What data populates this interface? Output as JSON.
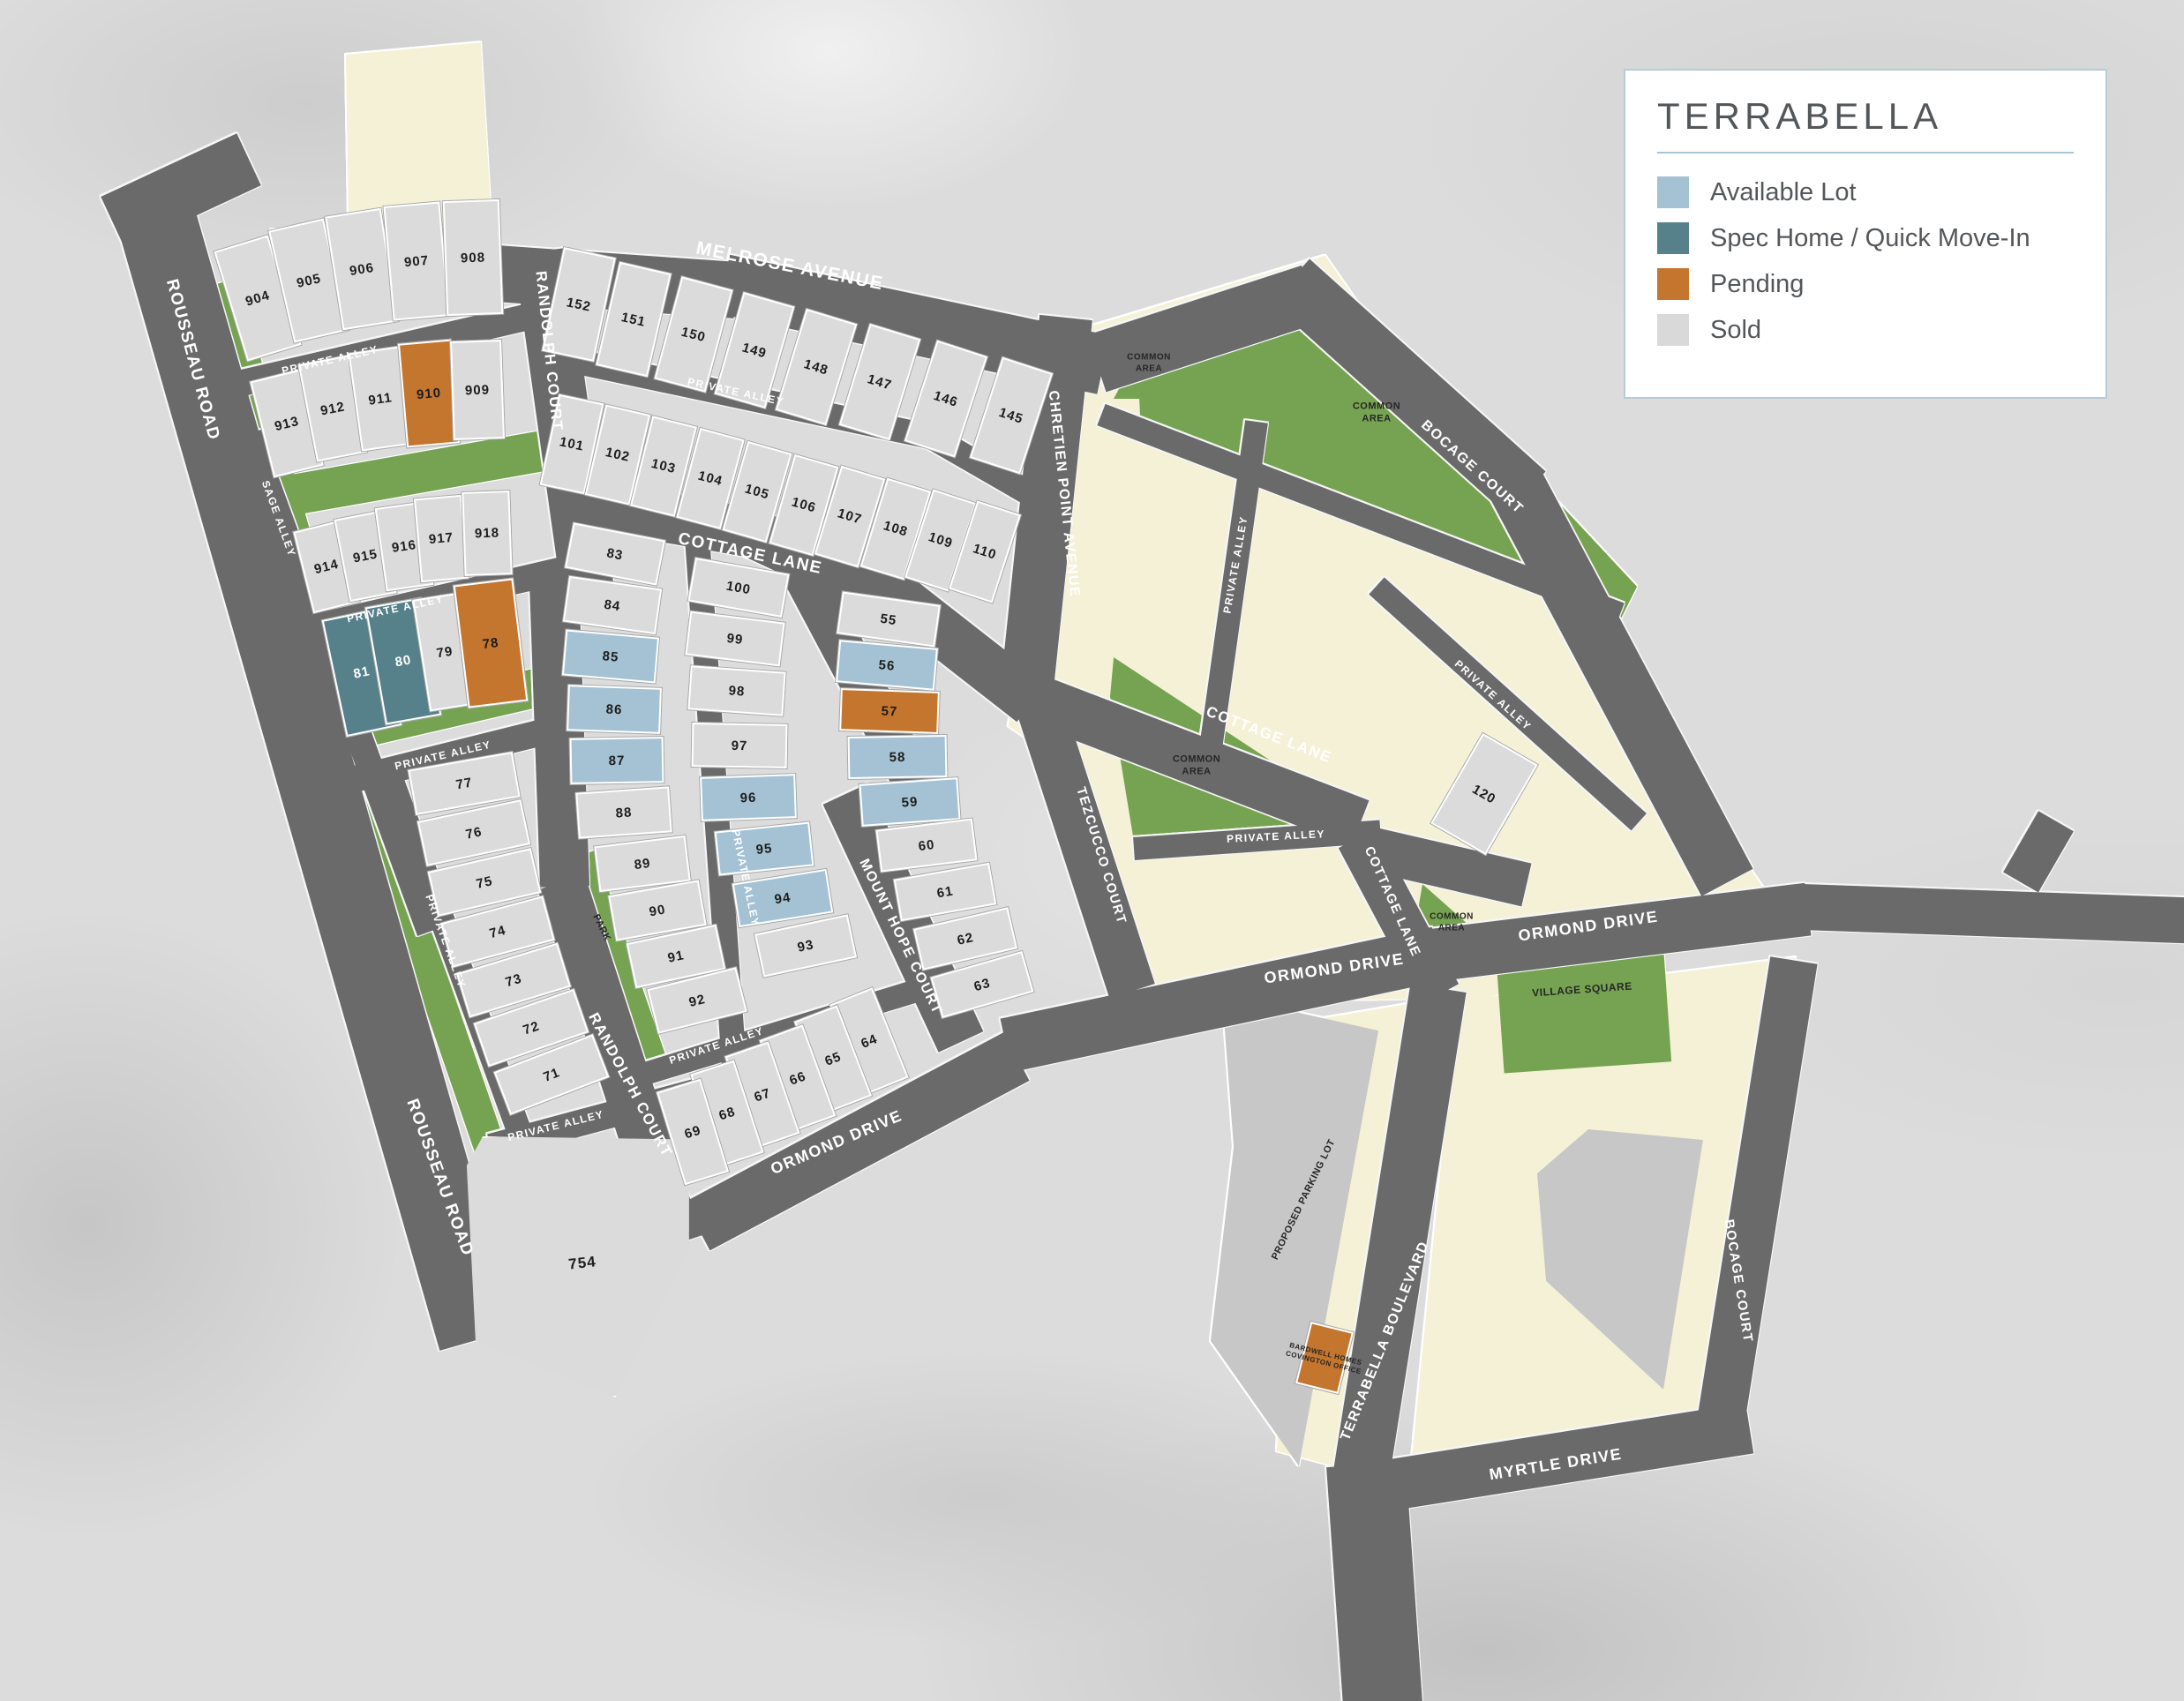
{
  "legend": {
    "title": "TERRABELLA",
    "items": [
      {
        "label": "Available Lot",
        "color": "#a4c2d3",
        "key": "available"
      },
      {
        "label": "Spec Home / Quick Move-In",
        "color": "#56808a",
        "key": "spec"
      },
      {
        "label": "Pending",
        "color": "#c4752e",
        "key": "pending"
      },
      {
        "label": "Sold",
        "color": "#d9d9d9",
        "key": "sold"
      }
    ]
  },
  "colors": {
    "available": "#a4c2d3",
    "spec": "#56808a",
    "pending": "#c4752e",
    "sold": "#dbdbdb",
    "road": "#6a6a6a",
    "green": "#76a351",
    "cream": "#f4f1d6",
    "pad": "#c7c7c7",
    "ink": "#54575a",
    "panel_border": "#b7cbd7",
    "rule": "#a8c4d6"
  },
  "lot_fields": [
    "number",
    "status(a=available,q=spec,p=pending,s=sold)",
    "cx",
    "cy",
    "w",
    "h",
    "rotate_deg",
    "clip_polygon(optional)"
  ],
  "lots": [
    [
      "904",
      "s",
      292,
      338,
      64,
      130,
      -17
    ],
    [
      "905",
      "s",
      350,
      318,
      64,
      130,
      -13
    ],
    [
      "906",
      "s",
      410,
      305,
      64,
      130,
      -9
    ],
    [
      "907",
      "s",
      472,
      296,
      64,
      130,
      -5
    ],
    [
      "908",
      "s",
      536,
      292,
      64,
      130,
      -2
    ],
    [
      "913",
      "s",
      325,
      480,
      58,
      112,
      -14
    ],
    [
      "912",
      "s",
      377,
      463,
      58,
      112,
      -11
    ],
    [
      "911",
      "s",
      431,
      452,
      58,
      112,
      -8
    ],
    [
      "910",
      "p",
      486,
      446,
      60,
      118,
      -5
    ],
    [
      "909",
      "s",
      541,
      442,
      58,
      112,
      -2
    ],
    [
      "914",
      "s",
      370,
      642,
      54,
      95,
      -14
    ],
    [
      "915",
      "s",
      414,
      630,
      54,
      95,
      -11
    ],
    [
      "916",
      "s",
      458,
      619,
      54,
      95,
      -8
    ],
    [
      "917",
      "s",
      500,
      610,
      54,
      95,
      -5
    ],
    [
      "918",
      "s",
      552,
      604,
      54,
      95,
      -2
    ],
    [
      "81",
      "q",
      410,
      762,
      64,
      135,
      -12
    ],
    [
      "80",
      "q",
      457,
      749,
      64,
      135,
      -10
    ],
    [
      "79",
      "s",
      504,
      739,
      54,
      128,
      -9
    ],
    [
      "78",
      "p",
      556,
      729,
      68,
      140,
      -7
    ],
    [
      "77",
      "s",
      526,
      888,
      120,
      52,
      -10
    ],
    [
      "76",
      "s",
      537,
      944,
      120,
      52,
      -12
    ],
    [
      "75",
      "s",
      549,
      1000,
      120,
      52,
      -13
    ],
    [
      "74",
      "s",
      564,
      1056,
      120,
      52,
      -15
    ],
    [
      "73",
      "s",
      582,
      1111,
      120,
      52,
      -17
    ],
    [
      "72",
      "s",
      602,
      1165,
      120,
      52,
      -19
    ],
    [
      "71",
      "s",
      625,
      1218,
      120,
      52,
      -21
    ],
    [
      "754",
      "s",
      660,
      1432,
      270,
      310,
      -6,
      "14% 0%,100% 9%,95% 50%,58% 100%,2% 74%,6% 10%"
    ],
    [
      "152",
      "s",
      656,
      345,
      60,
      120,
      12
    ],
    [
      "151",
      "s",
      718,
      362,
      60,
      120,
      13
    ],
    [
      "150",
      "s",
      786,
      379,
      60,
      120,
      15
    ],
    [
      "149",
      "s",
      855,
      397,
      60,
      120,
      16
    ],
    [
      "148",
      "s",
      925,
      416,
      60,
      120,
      17
    ],
    [
      "147",
      "s",
      997,
      433,
      60,
      120,
      17
    ],
    [
      "146",
      "s",
      1072,
      452,
      60,
      120,
      18
    ],
    [
      "145",
      "s",
      1146,
      471,
      60,
      120,
      18
    ],
    [
      "101",
      "s",
      648,
      503,
      52,
      105,
      12
    ],
    [
      "102",
      "s",
      700,
      515,
      52,
      105,
      13
    ],
    [
      "103",
      "s",
      752,
      528,
      52,
      105,
      14
    ],
    [
      "104",
      "s",
      805,
      542,
      52,
      105,
      15
    ],
    [
      "105",
      "s",
      858,
      557,
      52,
      105,
      16
    ],
    [
      "106",
      "s",
      911,
      572,
      52,
      105,
      16
    ],
    [
      "107",
      "s",
      963,
      585,
      52,
      105,
      17
    ],
    [
      "108",
      "s",
      1015,
      599,
      52,
      105,
      17
    ],
    [
      "109",
      "s",
      1066,
      612,
      52,
      105,
      18
    ],
    [
      "110",
      "s",
      1116,
      625,
      52,
      105,
      18
    ],
    [
      "83",
      "s",
      697,
      628,
      106,
      52,
      11
    ],
    [
      "84",
      "s",
      694,
      686,
      106,
      52,
      8
    ],
    [
      "85",
      "a",
      692,
      744,
      106,
      52,
      5
    ],
    [
      "86",
      "a",
      696,
      804,
      106,
      52,
      2
    ],
    [
      "87",
      "a",
      699,
      862,
      106,
      52,
      -1
    ],
    [
      "88",
      "s",
      707,
      921,
      106,
      52,
      -4
    ],
    [
      "89",
      "s",
      728,
      979,
      104,
      52,
      -7
    ],
    [
      "90",
      "s",
      745,
      1032,
      104,
      52,
      -10
    ],
    [
      "91",
      "s",
      766,
      1084,
      104,
      52,
      -12
    ],
    [
      "92",
      "s",
      790,
      1134,
      104,
      52,
      -14
    ],
    [
      "100",
      "s",
      837,
      666,
      108,
      50,
      10
    ],
    [
      "99",
      "s",
      833,
      724,
      108,
      50,
      7
    ],
    [
      "98",
      "s",
      835,
      783,
      108,
      50,
      4
    ],
    [
      "97",
      "s",
      838,
      845,
      108,
      50,
      1
    ],
    [
      "96",
      "a",
      848,
      904,
      108,
      50,
      -2
    ],
    [
      "95",
      "a",
      866,
      962,
      108,
      50,
      -6
    ],
    [
      "94",
      "a",
      887,
      1018,
      108,
      50,
      -9
    ],
    [
      "93",
      "s",
      913,
      1072,
      108,
      50,
      -12
    ],
    [
      "55",
      "s",
      1007,
      702,
      112,
      48,
      8
    ],
    [
      "56",
      "a",
      1005,
      754,
      112,
      48,
      5
    ],
    [
      "57",
      "p",
      1008,
      806,
      112,
      48,
      2
    ],
    [
      "58",
      "a",
      1017,
      858,
      112,
      48,
      -1
    ],
    [
      "59",
      "a",
      1031,
      909,
      112,
      48,
      -4
    ],
    [
      "60",
      "s",
      1050,
      958,
      110,
      48,
      -7
    ],
    [
      "61",
      "s",
      1071,
      1011,
      110,
      48,
      -10
    ],
    [
      "62",
      "s",
      1094,
      1064,
      110,
      48,
      -13
    ],
    [
      "63",
      "s",
      1113,
      1116,
      108,
      48,
      -16
    ],
    [
      "64",
      "s",
      985,
      1180,
      52,
      110,
      -22
    ],
    [
      "65",
      "s",
      944,
      1200,
      52,
      110,
      -21
    ],
    [
      "66",
      "s",
      904,
      1222,
      52,
      110,
      -20
    ],
    [
      "67",
      "s",
      864,
      1241,
      52,
      110,
      -19
    ],
    [
      "68",
      "s",
      824,
      1262,
      52,
      110,
      -18
    ],
    [
      "69",
      "s",
      785,
      1283,
      52,
      110,
      -17
    ],
    [
      "120",
      "s",
      1682,
      900,
      72,
      118,
      30
    ],
    [
      "",
      "p",
      1501,
      1539,
      50,
      72,
      14
    ]
  ],
  "road_fields": [
    "name",
    "x",
    "y",
    "length",
    "angle_deg",
    "thickness"
  ],
  "roads": [
    [
      "rousseau",
      175,
      240,
      1330,
      74,
      90
    ],
    [
      "rousseau-stub",
      128,
      252,
      170,
      -25,
      65
    ],
    [
      "melrose-1",
      305,
      292,
      530,
      4,
      64
    ],
    [
      "melrose-2",
      820,
      322,
      440,
      12,
      68
    ],
    [
      "melrose-3",
      1243,
      412,
      255,
      -18,
      68
    ],
    [
      "bocage-1",
      1462,
      318,
      360,
      42,
      66
    ],
    [
      "bocage-2",
      1718,
      550,
      510,
      62,
      66
    ],
    [
      "randolph-upper",
      612,
      285,
      390,
      82,
      60
    ],
    [
      "alley-a",
      240,
      442,
      380,
      -13,
      30
    ],
    [
      "sage-alley",
      282,
      492,
      600,
      70,
      30
    ],
    [
      "alley-b",
      352,
      712,
      300,
      -13,
      30
    ],
    [
      "alley-c",
      398,
      884,
      265,
      -14,
      30
    ],
    [
      "alley-d",
      442,
      880,
      450,
      70,
      28
    ],
    [
      "alley-e",
      556,
      1300,
      250,
      -15,
      30
    ],
    [
      "randolph-lower-1",
      628,
      660,
      345,
      88,
      56
    ],
    [
      "randolph-lower-2",
      636,
      1000,
      430,
      72,
      56
    ],
    [
      "ormond-1",
      790,
      1390,
      410,
      -28,
      62
    ],
    [
      "ormond-2",
      1140,
      1185,
      500,
      -12,
      62
    ],
    [
      "ormond-3",
      1622,
      1083,
      430,
      -7,
      60
    ],
    [
      "ormond-4",
      2042,
      1028,
      440,
      2,
      52
    ],
    [
      "ormond-stub",
      2290,
      1000,
      80,
      -60,
      46
    ],
    [
      "chretien",
      1208,
      360,
      420,
      96,
      60
    ],
    [
      "tezcucco",
      1178,
      800,
      340,
      72,
      54
    ],
    [
      "cottage-1",
      648,
      568,
      210,
      10,
      56
    ],
    [
      "cottage-2",
      848,
      602,
      185,
      25,
      56
    ],
    [
      "cottage-3",
      1008,
      670,
      205,
      38,
      56
    ],
    [
      "cottage-4",
      1168,
      790,
      400,
      21,
      56
    ],
    [
      "cottage-5",
      1535,
      958,
      200,
      13,
      50
    ],
    [
      "cottage-south",
      1538,
      950,
      200,
      62,
      48
    ],
    [
      "mount-hope",
      958,
      900,
      310,
      65,
      56
    ],
    [
      "alley-f",
      790,
      608,
      640,
      86,
      28
    ],
    [
      "alley-m",
      905,
      640,
      290,
      62,
      48
    ],
    [
      "alley-g",
      695,
      1228,
      370,
      -17,
      26
    ],
    [
      "alley-h1",
      645,
      408,
      420,
      12,
      28
    ],
    [
      "alley-h2",
      1050,
      492,
      130,
      30,
      28
    ],
    [
      "alley-i",
      1285,
      962,
      280,
      -4,
      26
    ],
    [
      "alley-v1",
      1424,
      478,
      390,
      98,
      26
    ],
    [
      "alley-v2",
      1560,
      664,
      400,
      42,
      26
    ],
    [
      "alley-v3",
      1248,
      470,
      630,
      21,
      26
    ],
    [
      "myrtle",
      1558,
      1686,
      430,
      -9,
      58
    ],
    [
      "bocage-lower",
      1950,
      1612,
      530,
      -81,
      54
    ],
    [
      "terrabella-1",
      1630,
      1120,
      560,
      99,
      64
    ],
    [
      "terrabella-2",
      1548,
      1660,
      300,
      86,
      90
    ]
  ],
  "green_strips": [
    [
      "green-rousseau-north",
      252,
      320,
      560,
      74,
      36
    ],
    [
      "green-rousseau-south",
      400,
      850,
      480,
      71,
      36
    ],
    [
      "green-sage-band",
      292,
      568,
      350,
      -10,
      46
    ],
    [
      "green-band-mid",
      355,
      838,
      300,
      -13,
      44
    ],
    [
      "park-strip",
      662,
      968,
      250,
      71,
      26
    ]
  ],
  "shape_fields": [
    "kind",
    "x",
    "y",
    "w",
    "h",
    "clip_points",
    "rotate_deg"
  ],
  "shapes": [
    [
      "cream",
      388,
      46,
      174,
      266,
      "2.3% 6%,90.2% .8%,98.9% 95.5%,4.6% 99.2%",
      0
    ],
    [
      "cream",
      1140,
      288,
      882,
      864,
      "10.2% 9.7%,41% .2%,99.8% 86.8%,55% 99.5%,.3% 61.9%",
      0
    ],
    [
      "cream",
      1158,
      742,
      467,
      398,
      "2.1% 27.6%,29.3% .5%,82.9% 54.3%,99.4% 98%,26.6% 99.5%",
      0
    ],
    [
      "cream",
      1590,
      1085,
      445,
      575,
      "13% 8.7%,100% 0%,82% 90.4%,2.2% 99.1%,10.1% 37.4%",
      0
    ],
    [
      "cream",
      1445,
      1130,
      187,
      545,
      "10.7% 5.5%,98.9% .4%,56.1% 99.4%,1.1% 94.5%",
      0
    ],
    [
      "gray",
      1370,
      1125,
      195,
      540,
      "7.7% .6%,98.5% 8%,52.3% 99.4%,1% 73.1%,14.4% 32.4%",
      0
    ],
    [
      "gray",
      1740,
      1280,
      195,
      300,
      "30.8% 0%,97.4% 4%,74.4% 98.3%,6.2% 57.3%,1% 16.7%",
      0
    ],
    [
      "green",
      1288,
      328,
      574,
      382,
      ".3% 24.1%,36.9% 1.8%,75.3% 50.3%,98.8% 88.2%,95.3% 98.7%,.7% 37.7%",
      0
    ],
    [
      "green",
      1262,
      382,
      90,
      70,
      "0% 100%,42% 0%,100% 66%,87% 100%",
      0
    ],
    [
      "green",
      1258,
      742,
      272,
      216,
      "1.5% 1.4%,98% 81.5%,89% 97%,10% 98.6%,0% 22%",
      0
    ],
    [
      "green",
      1598,
      1002,
      102,
      83,
      "13.7% 0%,100% 94%,0% 100%",
      0
    ],
    [
      "green",
      1700,
      1085,
      190,
      125,
      "",
      -4
    ]
  ],
  "street_label_fields": [
    "text",
    "x",
    "y",
    "rotate_deg",
    "font_px"
  ],
  "street_labels": [
    [
      "MELROSE AVENUE",
      895,
      302,
      11,
      21
    ],
    [
      "RANDOLPH COURT",
      622,
      398,
      84,
      17
    ],
    [
      "RANDOLPH COURT",
      714,
      1230,
      62,
      17
    ],
    [
      "ROUSSEAU ROAD",
      218,
      408,
      75,
      19
    ],
    [
      "ROUSSEAU ROAD",
      498,
      1335,
      70,
      19
    ],
    [
      "PRIVATE ALLEY",
      374,
      408,
      -13,
      12
    ],
    [
      "PRIVATE ALLEY",
      448,
      690,
      -12,
      12
    ],
    [
      "SAGE ALLEY",
      316,
      588,
      70,
      12
    ],
    [
      "PRIVATE ALLEY",
      502,
      856,
      -13,
      12
    ],
    [
      "PRIVATE ALLEY",
      505,
      1067,
      70,
      12
    ],
    [
      "PRIVATE ALLEY",
      630,
      1276,
      -14,
      12
    ],
    [
      "PRIVATE ALLEY",
      834,
      444,
      12,
      12
    ],
    [
      "PRIVATE ALLEY",
      845,
      995,
      78,
      12
    ],
    [
      "PRIVATE ALLEY",
      812,
      1185,
      -18,
      12
    ],
    [
      "COTTAGE LANE",
      850,
      628,
      12,
      19
    ],
    [
      "CHRETIEN POINT AVENUE",
      1205,
      560,
      84,
      16
    ],
    [
      "MOUNT HOPE COURT",
      1020,
      1062,
      64,
      16
    ],
    [
      "ORMOND DRIVE",
      948,
      1295,
      -23,
      18
    ],
    [
      "ORMOND DRIVE",
      1512,
      1098,
      -8,
      18
    ],
    [
      "ORMOND DRIVE",
      1800,
      1050,
      -8,
      18
    ],
    [
      "TEZCUCCO COURT",
      1248,
      970,
      73,
      15
    ],
    [
      "COTTAGE LANE",
      1438,
      833,
      21,
      17
    ],
    [
      "COTTAGE LANE",
      1578,
      1022,
      66,
      15
    ],
    [
      "PRIVATE ALLEY",
      1400,
      640,
      -80,
      12
    ],
    [
      "PRIVATE ALLEY",
      1692,
      788,
      42,
      12
    ],
    [
      "PRIVATE ALLEY",
      1446,
      948,
      -3,
      12
    ],
    [
      "BOCAGE COURT",
      1668,
      530,
      42,
      16
    ],
    [
      "BOCAGE COURT",
      1970,
      1452,
      81,
      15
    ],
    [
      "TERRABELLA BOULEVARD",
      1570,
      1520,
      -68,
      16
    ],
    [
      "MYRTLE DRIVE",
      1763,
      1660,
      -9,
      18
    ]
  ],
  "area_labels": [
    [
      "COMMON\nAREA",
      1302,
      412,
      0,
      10
    ],
    [
      "COMMON\nAREA",
      1560,
      468,
      0,
      11
    ],
    [
      "COMMON\nAREA",
      1356,
      868,
      0,
      11
    ],
    [
      "COMMON\nAREA",
      1645,
      1046,
      0,
      10
    ],
    [
      "VILLAGE SQUARE",
      1793,
      1122,
      -4,
      12
    ],
    [
      "PARK",
      681,
      1052,
      64,
      11
    ],
    [
      "PROPOSED PARKING LOT",
      1478,
      1360,
      -64,
      11
    ],
    [
      "BARDWELL HOMES\nCOVINGTON OFFICE",
      1501,
      1540,
      14,
      8
    ]
  ]
}
